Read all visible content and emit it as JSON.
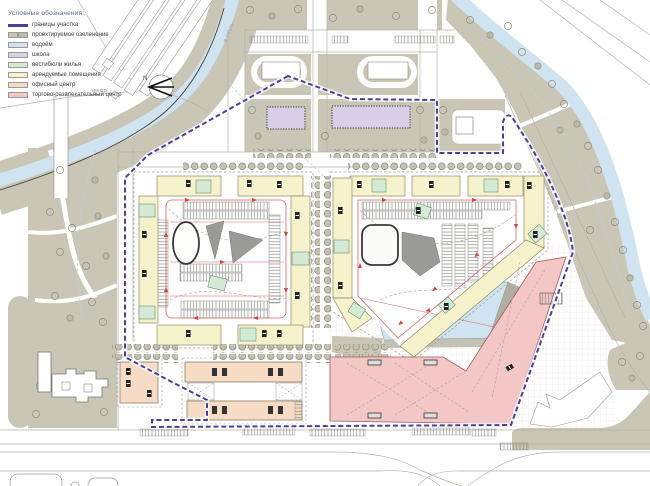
{
  "legend": {
    "title": "Условные обозначения:",
    "items": [
      {
        "label": "границы участка",
        "type": "line"
      },
      {
        "label": "проектируемое озеленение",
        "type": "double"
      },
      {
        "label": "водоём",
        "type": "fill"
      },
      {
        "label": "школа",
        "type": "fill"
      },
      {
        "label": "вестибюли жилья",
        "type": "fill"
      },
      {
        "label": "арендуемые помещения",
        "type": "fill"
      },
      {
        "label": "офисный центр",
        "type": "fill"
      },
      {
        "label": "торгово-развлекательный центр",
        "type": "fill"
      }
    ]
  },
  "annotations": {
    "north_label": "N",
    "river_label": "р. Сетунь",
    "partial_label": "центр"
  },
  "colors": {
    "site_boundary": "#4b3f9e",
    "greenery": "#c9c6b6",
    "greenery2": "#bdbcb2",
    "water": "#cfe3f0",
    "school": "#d9cfe8",
    "lobby": "#d4ead6",
    "rental": "#f6f2cc",
    "office": "#f6dcc4",
    "retail": "#f2c7c5",
    "circulation": "#d6423a"
  }
}
